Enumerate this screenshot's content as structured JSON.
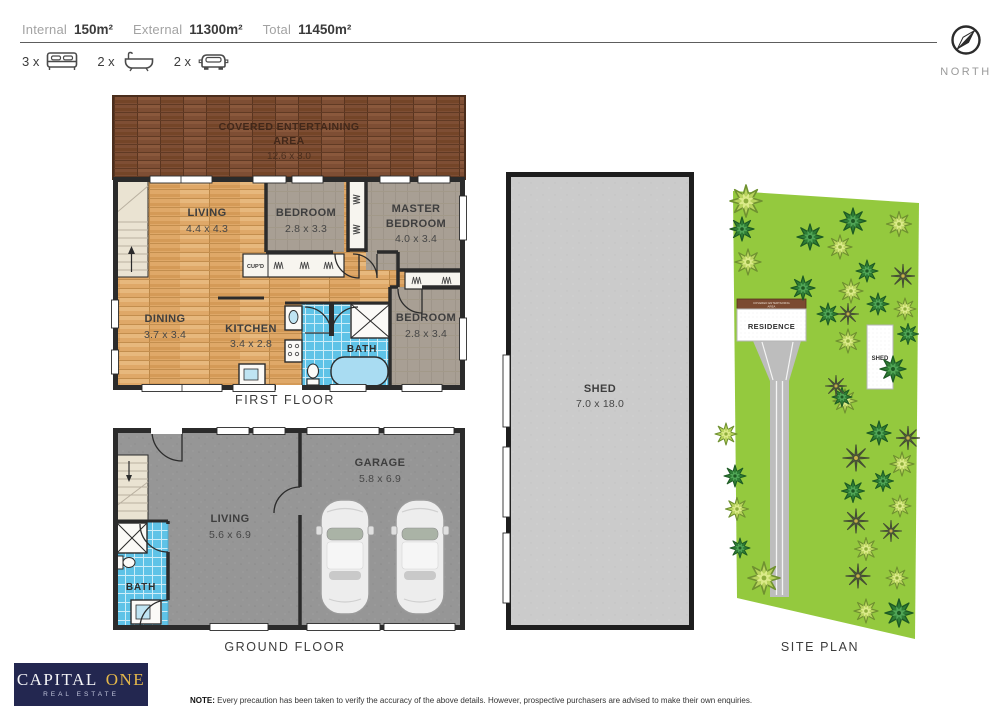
{
  "header": {
    "stats": [
      {
        "label": "Internal",
        "value": "150m²"
      },
      {
        "label": "External",
        "value": "11300m²"
      },
      {
        "label": "Total",
        "value": "11450m²"
      }
    ],
    "features": [
      {
        "count": "3 x",
        "icon": "bed-icon"
      },
      {
        "count": "2 x",
        "icon": "bath-icon"
      },
      {
        "count": "2 x",
        "icon": "car-icon"
      }
    ]
  },
  "compass": {
    "label": "NORTH"
  },
  "first_floor": {
    "title": "FIRST FLOOR",
    "deck": {
      "line1": "COVERED ENTERTAINING",
      "line2": "AREA",
      "dims": "12.6 x 3.0"
    },
    "rooms": {
      "living": {
        "name": "LIVING",
        "dims": "4.4 x 4.3"
      },
      "bedroom2": {
        "name": "BEDROOM",
        "dims": "2.8 x 3.3"
      },
      "master": {
        "name1": "MASTER",
        "name2": "BEDROOM",
        "dims": "4.0 x 3.4"
      },
      "dining": {
        "name": "DINING",
        "dims": "3.7 x 3.4"
      },
      "kitchen": {
        "name": "KITCHEN",
        "dims": "3.4 x 2.8"
      },
      "bath": {
        "name": "BATH"
      },
      "bedroom3": {
        "name": "BEDROOM",
        "dims": "2.8 x 3.4"
      },
      "cupboard": {
        "name": "CUP'D"
      }
    }
  },
  "ground_floor": {
    "title": "GROUND FLOOR",
    "rooms": {
      "living": {
        "name": "LIVING",
        "dims": "5.6 x 6.9"
      },
      "garage": {
        "name": "GARAGE",
        "dims": "5.8 x 6.9"
      },
      "bath": {
        "name": "BATH"
      }
    }
  },
  "shed": {
    "name": "SHED",
    "dims": "7.0 x 18.0"
  },
  "site_plan": {
    "title": "SITE PLAN",
    "residence_label": "RESIDENCE",
    "residence_deck_line1": "COVERED ENTERTAINING",
    "residence_deck_line2": "AREA",
    "shed_label": "SHED",
    "trees": [
      {
        "x": 746,
        "y": 201,
        "s": 1.6,
        "t": "l"
      },
      {
        "x": 748,
        "y": 262,
        "s": 1.3,
        "t": "l"
      },
      {
        "x": 840,
        "y": 247,
        "s": 1.2,
        "t": "l"
      },
      {
        "x": 899,
        "y": 224,
        "s": 1.25,
        "t": "l"
      },
      {
        "x": 851,
        "y": 291,
        "s": 1.2,
        "t": "l"
      },
      {
        "x": 905,
        "y": 309,
        "s": 1.1,
        "t": "l"
      },
      {
        "x": 848,
        "y": 341,
        "s": 1.2,
        "t": "l"
      },
      {
        "x": 845,
        "y": 401,
        "s": 1.2,
        "t": "l"
      },
      {
        "x": 726,
        "y": 434,
        "s": 1.1,
        "t": "l"
      },
      {
        "x": 737,
        "y": 509,
        "s": 1.15,
        "t": "l"
      },
      {
        "x": 764,
        "y": 578,
        "s": 1.6,
        "t": "l"
      },
      {
        "x": 902,
        "y": 464,
        "s": 1.2,
        "t": "l"
      },
      {
        "x": 900,
        "y": 506,
        "s": 1.1,
        "t": "l"
      },
      {
        "x": 866,
        "y": 549,
        "s": 1.15,
        "t": "l"
      },
      {
        "x": 897,
        "y": 578,
        "s": 1.1,
        "t": "l"
      },
      {
        "x": 866,
        "y": 611,
        "s": 1.2,
        "t": "l"
      },
      {
        "x": 742,
        "y": 229,
        "s": 1.2,
        "t": "d"
      },
      {
        "x": 810,
        "y": 237,
        "s": 1.3,
        "t": "d"
      },
      {
        "x": 853,
        "y": 221,
        "s": 1.3,
        "t": "d"
      },
      {
        "x": 867,
        "y": 271,
        "s": 1.1,
        "t": "d"
      },
      {
        "x": 803,
        "y": 288,
        "s": 1.2,
        "t": "d"
      },
      {
        "x": 828,
        "y": 314,
        "s": 1.1,
        "t": "d"
      },
      {
        "x": 878,
        "y": 304,
        "s": 1.1,
        "t": "d"
      },
      {
        "x": 908,
        "y": 334,
        "s": 1.05,
        "t": "d"
      },
      {
        "x": 893,
        "y": 369,
        "s": 1.3,
        "t": "d"
      },
      {
        "x": 735,
        "y": 476,
        "s": 1.1,
        "t": "d"
      },
      {
        "x": 740,
        "y": 548,
        "s": 1.0,
        "t": "d"
      },
      {
        "x": 879,
        "y": 433,
        "s": 1.2,
        "t": "d"
      },
      {
        "x": 883,
        "y": 481,
        "s": 1.05,
        "t": "d"
      },
      {
        "x": 853,
        "y": 491,
        "s": 1.15,
        "t": "d"
      },
      {
        "x": 899,
        "y": 613,
        "s": 1.4,
        "t": "d"
      },
      {
        "x": 842,
        "y": 397,
        "s": 1.0,
        "t": "d"
      },
      {
        "x": 903,
        "y": 276,
        "s": 1.15,
        "t": "p"
      },
      {
        "x": 848,
        "y": 314,
        "s": 1.05,
        "t": "p"
      },
      {
        "x": 856,
        "y": 458,
        "s": 1.3,
        "t": "p"
      },
      {
        "x": 908,
        "y": 438,
        "s": 1.15,
        "t": "p"
      },
      {
        "x": 856,
        "y": 521,
        "s": 1.2,
        "t": "p"
      },
      {
        "x": 891,
        "y": 531,
        "s": 1.05,
        "t": "p"
      },
      {
        "x": 858,
        "y": 576,
        "s": 1.2,
        "t": "p"
      },
      {
        "x": 836,
        "y": 386,
        "s": 1.05,
        "t": "p"
      }
    ]
  },
  "logo": {
    "part1": "CAPITAL",
    "part2": "ONE",
    "tagline": "REAL ESTATE"
  },
  "note": {
    "prefix": "NOTE:",
    "body": "Every precaution has been taken to verify the accuracy of the above details. However, prospective purchasers are advised to make their own enquiries."
  },
  "colors": {
    "brand_navy": "#232750",
    "brand_gold": "#e5b84a",
    "grass_green": "#94c93e",
    "tile_blue": "#5fc3e7",
    "light_wood": "#dfa868",
    "deck_wood": "#7e4e34",
    "carpet": "#a89f94",
    "concrete": "#969696",
    "shed_grey": "#cbcbcb",
    "wall": "#2b2b2b"
  }
}
